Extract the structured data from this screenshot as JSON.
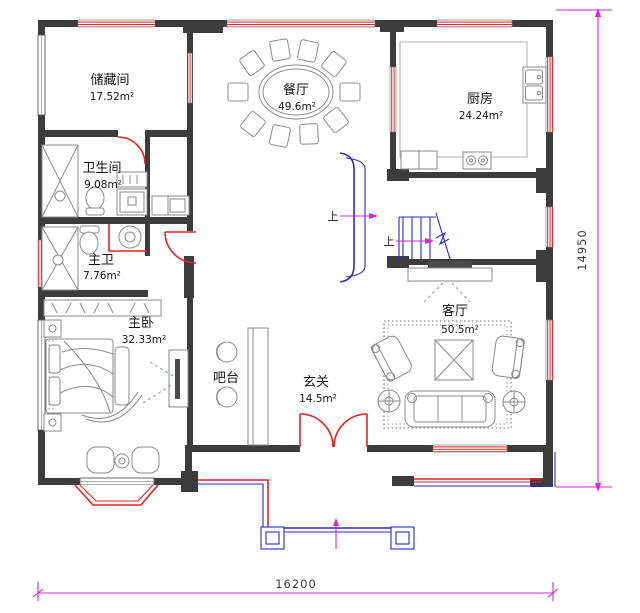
{
  "drawing_type": "residential-floor-plan",
  "rooms": {
    "storage": {
      "name": "储藏间",
      "area": "17.52m²"
    },
    "dining": {
      "name": "餐厅",
      "area": "49.6m²"
    },
    "kitchen": {
      "name": "厨房",
      "area": "24.24m²"
    },
    "bathroom": {
      "name": "卫生间",
      "area": "9.08m²"
    },
    "master_bath": {
      "name": "主卫",
      "area": "7.76m²"
    },
    "master_bedroom": {
      "name": "主卧",
      "area": "32.33m²"
    },
    "bar": {
      "name": "吧台"
    },
    "entry": {
      "name": "玄关",
      "area": "14.5m²"
    },
    "living": {
      "name": "客厅",
      "area": "50.5m²"
    }
  },
  "stairs": {
    "up_label_left": "上",
    "up_label_right": "上"
  },
  "dimensions": {
    "overall_width_mm": "16200",
    "overall_height_mm": "14950"
  },
  "palette": {
    "wall": "#3c3c3c",
    "door_window_red": "#e32222",
    "stair_porch_blue": "#2b2bd0",
    "dimension_magenta": "#e020e0",
    "furniture_line": "#8a8a8a",
    "text": "#141414"
  }
}
